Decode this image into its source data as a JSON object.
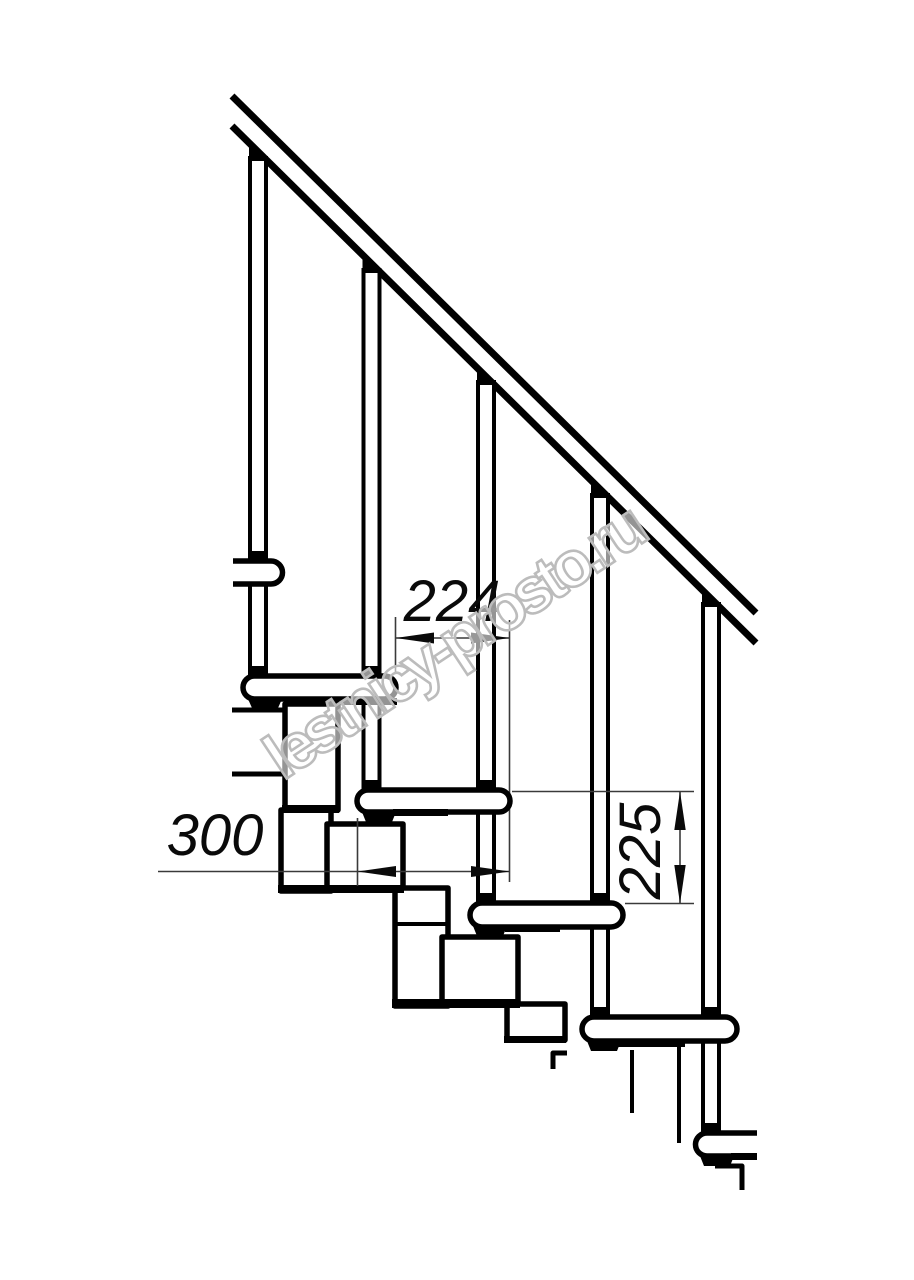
{
  "drawing": {
    "watermark": "lestnicy-prosto.ru",
    "dimensions": {
      "run": "224",
      "tread_depth": "300",
      "rise": "225"
    },
    "colors": {
      "line": "#000000",
      "watermark_outline": "#bcbcbc",
      "background": "#ffffff"
    }
  }
}
